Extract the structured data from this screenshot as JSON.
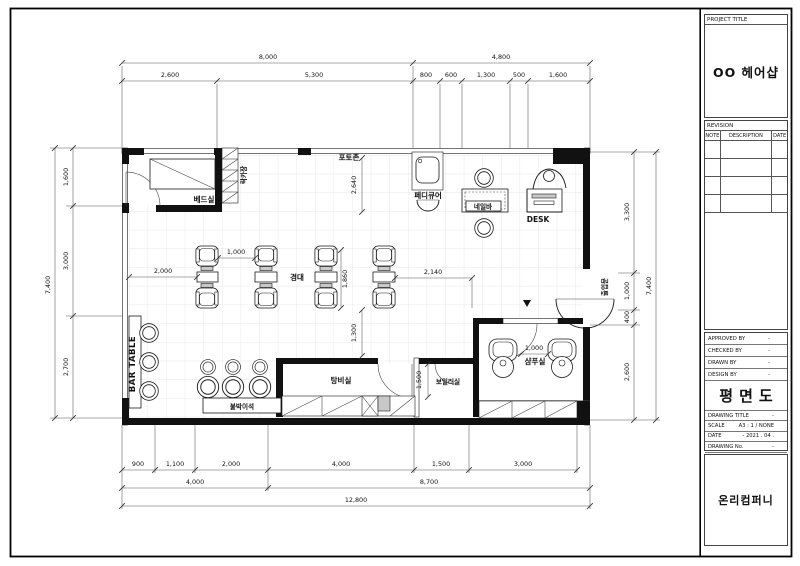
{
  "title_block": {
    "project_title_label": "PROJECT TITLE",
    "project_title": "OO 헤어샵",
    "revision_label": "REVISION",
    "rev_col_note": "NOTE",
    "rev_col_desc": "DESCRIPTION",
    "rev_col_date": "DATE",
    "approved_by_label": "APPROVED BY",
    "approved_by": "-",
    "checked_by_label": "CHECKED BY",
    "checked_by": "-",
    "drawn_by_label": "DRAWN BY",
    "drawn_by": "-",
    "design_by_label": "DESIGN BY",
    "design_by": "-",
    "drawing_name": "평면도",
    "drawing_title_label": "DRAWING TITLE",
    "drawing_title": "-",
    "scale_label": "SCALE",
    "scale": "A3 :  1 / NONE",
    "date_label": "DATE",
    "date": "-  2021 . 04 .",
    "drawing_no_label": "DRAWING No.",
    "drawing_no": "-",
    "sheet_no_label": "SHEET No.",
    "sheet_no": "",
    "company": "온리컴퍼니"
  },
  "plan": {
    "labels": {
      "bed_room": "베드실",
      "locker": "락카장",
      "photo_zone": "포토존",
      "pedicure": "페디큐어",
      "nail_bar": "네일바",
      "desk": "DESK",
      "mirror": "경대",
      "bar_table": "BAR TABLE",
      "built_in_seat": "붙박이석",
      "pantry": "탕비실",
      "boiler": "보일러실",
      "shampoo": "샴푸실",
      "entrance": "출입문"
    },
    "dims": {
      "top_outer": [
        "8,000",
        "4,800"
      ],
      "top_inner": [
        "2,600",
        "5,300",
        "800",
        "600",
        "1,300",
        "500",
        "1,600"
      ],
      "left_outer": "7,400",
      "left_inner": [
        "1,600",
        "3,000",
        "2,700"
      ],
      "right_inner": [
        "3,300",
        "1,000",
        "400",
        "2,600"
      ],
      "right_outer": "7,400",
      "bottom_inner": [
        "900",
        "1,100",
        "2,000",
        "4,000",
        "1,500",
        "3,000"
      ],
      "bottom_mid": [
        "4,000",
        "8,700"
      ],
      "bottom_outer": "12,800",
      "interior": {
        "photo": "2,640",
        "mirror_left": "2,000",
        "chair_gap": "1,000",
        "mirror_span": "1,860",
        "desk_side": "2,140",
        "pantry_side": "1,300",
        "boiler": "1,500",
        "shampoo_gap": "1,000"
      }
    }
  }
}
